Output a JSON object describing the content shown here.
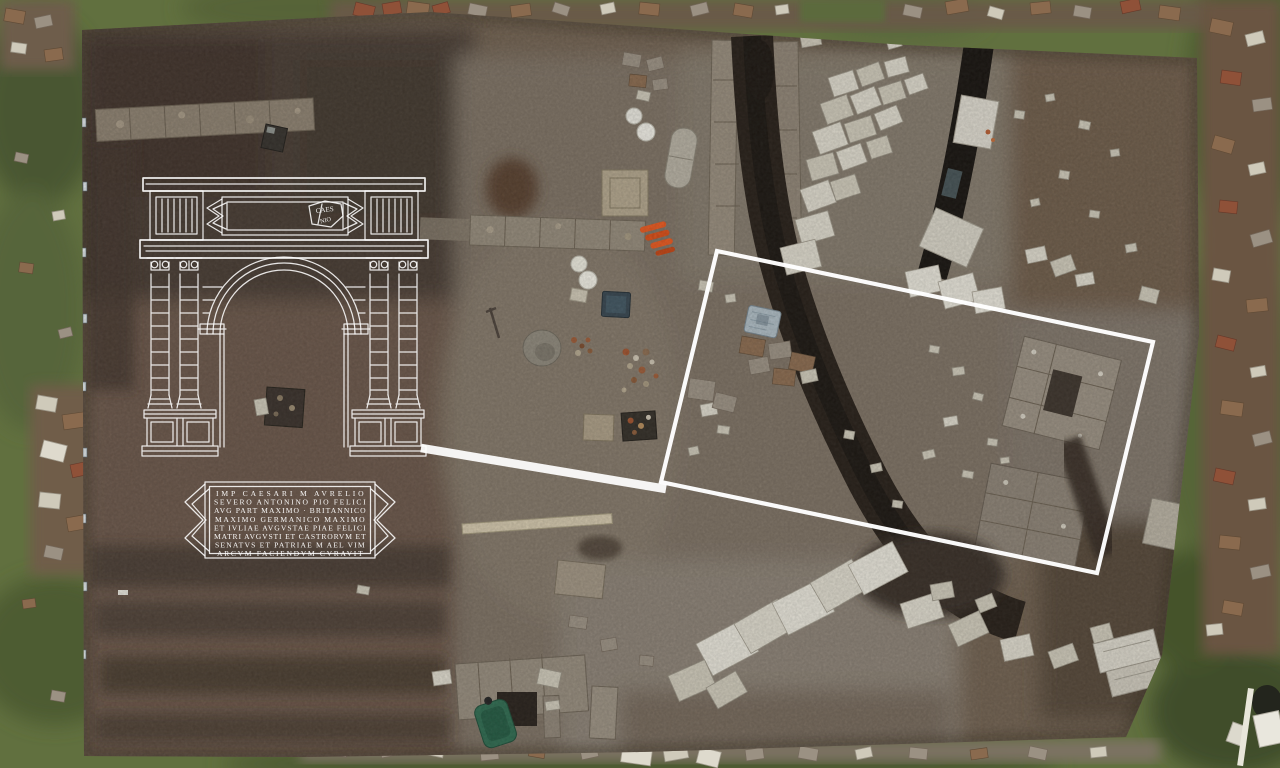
{
  "overlay": {
    "highlight_color": "#ffffff",
    "arch": {
      "attic_fragment": {
        "line1": "CAES",
        "line2": "NIO"
      }
    },
    "inscription": {
      "lines": [
        "IMP CAESARI M AVRELIO",
        "SEVERO ANTONINO PIO FELICI",
        "AVG PART MAXIMO · BRITANNICO",
        "MAXIMO GERMANICO MAXIMO",
        "ET IVLIAE AVGVSTAE PIAE FELICI",
        "MATRI AVGVSTI ET CASTRORVM ET",
        "SENATVS ET PATRIAE M AEL VIM",
        "ARCVM FACIENDVM CVRAVIT"
      ]
    }
  }
}
